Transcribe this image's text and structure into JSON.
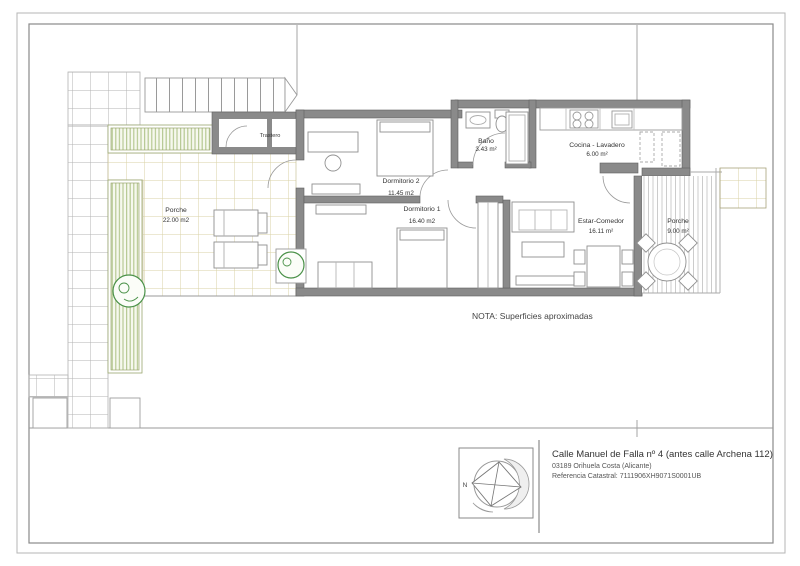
{
  "note": "NOTA: Superficies aproximadas",
  "rooms": {
    "porche_left": {
      "name": "Porche",
      "area": "22.00 m2"
    },
    "trastero": {
      "name": "Trastero"
    },
    "dormitorio2": {
      "name": "Dormitorio 2",
      "area": "11.45 m2"
    },
    "dormitorio1": {
      "name": "Dormitorio 1",
      "area": "16.40 m2"
    },
    "bano": {
      "name": "Baño",
      "area": "3.43 m²"
    },
    "cocina": {
      "name": "Cocina - Lavadero",
      "area": "6.00 m²"
    },
    "estar": {
      "name": "Estar-Comedor",
      "area": "16.11 m²"
    },
    "porche_right": {
      "name": "Porche",
      "area": "9.00 m²"
    }
  },
  "title_block": {
    "address_line1": "Calle Manuel de Falla nº 4 (antes calle Archena 112)",
    "address_line2": "03189 Orihuela Costa (Alicante)",
    "address_line3": "Referencia Catastral: 7111906XH9071S0001UB",
    "compass_north": "N"
  },
  "colors": {
    "wall": "#8a8a8a",
    "plan_line": "#999999",
    "grid_line": "#b3b3b3",
    "tile_line": "#d9d2a6",
    "green_stripe": "#b7c993",
    "tree": "#4a9148"
  }
}
